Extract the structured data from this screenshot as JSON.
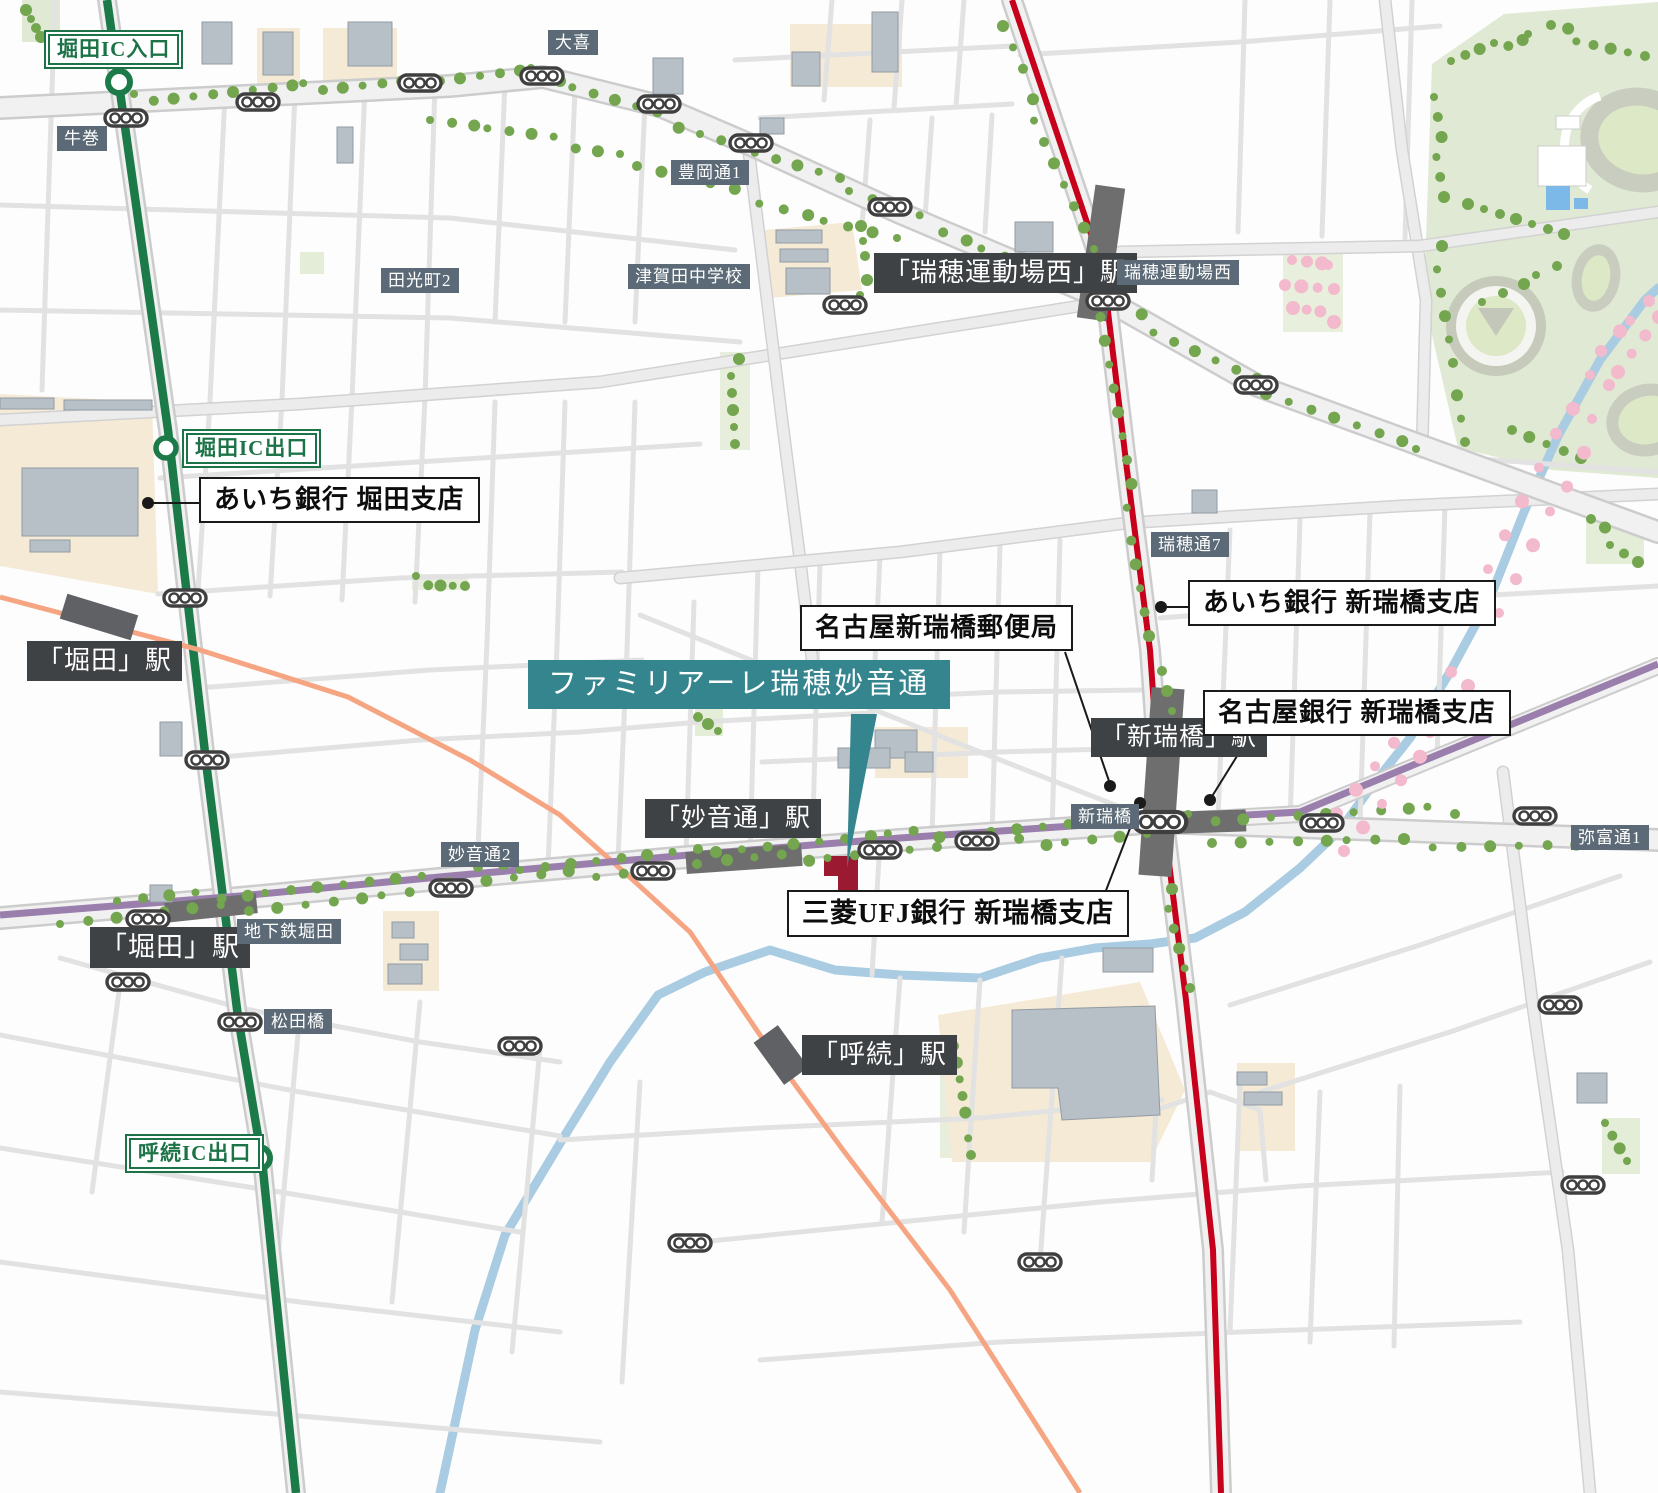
{
  "labels": {
    "ic": {
      "horita_in": "堀田IC入口",
      "horita_out": "堀田IC出口",
      "yobitsugi_out": "呼続IC出口"
    },
    "stations": {
      "mizuho_undojo_nishi": "「瑞穂運動場西」駅",
      "aratamabashi": "「新瑞橋」駅",
      "myoondori": "「妙音通」駅",
      "horita_meitetsu": "「堀田」駅",
      "horita_subway": "「堀田」駅",
      "yobitsugi": "「呼続」駅"
    },
    "places": {
      "ushimaki": "牛巻",
      "oki": "大喜",
      "toyooka_dori_1": "豊岡通1",
      "tamitsu_cho_2": "田光町2",
      "tsugata_junior_high": "津賀田中学校",
      "mizuho_undojo_nishi": "瑞穂運動場西",
      "mizuho_dori_7": "瑞穂通7",
      "myoon_dori_2": "妙音通2",
      "aratamabashi": "新瑞橋",
      "yatomi_dori_1": "弥富通1",
      "chikatetsu_horita": "地下鉄堀田",
      "matsudabashi": "松田橋"
    },
    "pois": {
      "aichi_bank_horita": "あいち銀行 堀田支店",
      "aichi_bank_aratamabashi": "あいち銀行 新瑞橋支店",
      "nagoya_aratamabashi_post_office": "名古屋新瑞橋郵便局",
      "nagoya_bank_aratamabashi": "名古屋銀行 新瑞橋支店",
      "mufg_bank_aratamabashi": "三菱UFJ銀行 新瑞橋支店"
    },
    "property": "ファミリアーレ瑞穂妙音通"
  },
  "colors": {
    "expressway_green": "#1c7a49",
    "ic_label_green": "#1c7347",
    "subway_red": "#c7001b",
    "meijo_purple": "#9a7fad",
    "meitetsu_orange": "#f6a583",
    "river_blue": "#a9cce2",
    "sakura_pink": "#f3b9cc",
    "tree_green": "#74a54f",
    "park_green": "#dfe9d3",
    "property_teal": "#35858f",
    "property_building_red": "#9c1a31",
    "station_label_bg": "#3e4245",
    "place_label_bg": "#5b6a76"
  }
}
